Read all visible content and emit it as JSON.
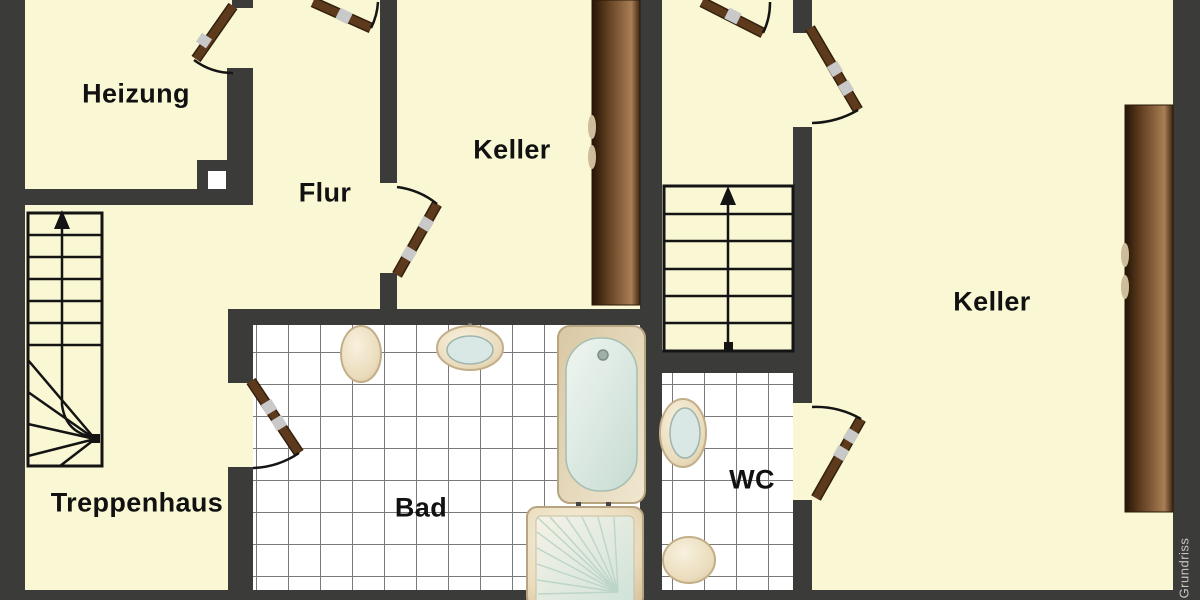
{
  "title": "Grundriss",
  "watermark": {
    "label": "Grundriss"
  },
  "rooms": {
    "heizung": {
      "label": "Heizung"
    },
    "flur": {
      "label": "Flur"
    },
    "keller_left": {
      "label": "Keller"
    },
    "keller_right": {
      "label": "Keller"
    },
    "treppenhaus": {
      "label": "Treppenhaus"
    },
    "bad": {
      "label": "Bad"
    },
    "wc": {
      "label": "WC"
    }
  },
  "stairs": {
    "main": {
      "treads": 6,
      "direction": "up-arrow"
    },
    "treppenhaus": {
      "straight_treads": 7,
      "winder_treads": 5,
      "direction": "up-arrow"
    }
  },
  "fixtures": [
    "toilet",
    "sink",
    "bathtub",
    "shower",
    "wc-sink",
    "wc-toilet"
  ],
  "doors": [
    "heizung",
    "flur-top",
    "flur-keller",
    "stairs-top-left",
    "stairs-top-right",
    "wc",
    "bad"
  ],
  "colors": {
    "background": "#FAF8D4",
    "wall": "#3B3B39",
    "door": "#5E3A1C",
    "tile_line": "#7a7a7a",
    "fixture": "#EADCBC",
    "water": "#D9E8E4",
    "cupboard": "#8A6038",
    "watermark_text": "#C4C4C4"
  }
}
